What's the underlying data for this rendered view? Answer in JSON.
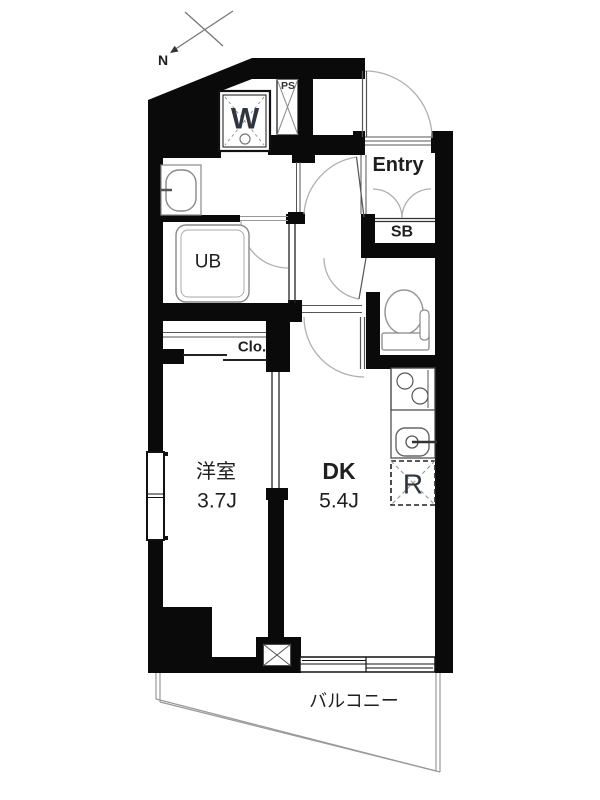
{
  "plan_title": "1DK apartment floor plan",
  "colors": {
    "walls": "#0a0a0a",
    "lines": "#999999",
    "text": "#1f1f1f",
    "fixture_letter": "#2e3440",
    "background": "#ffffff"
  },
  "compass": {
    "label": "N"
  },
  "rooms": {
    "entry": {
      "label": "Entry"
    },
    "shoe_box": {
      "label": "SB"
    },
    "unit_bath": {
      "label": "UB"
    },
    "closet": {
      "label": "Clo."
    },
    "western_room": {
      "label": "洋室",
      "size": "3.7J"
    },
    "dining_kitchen": {
      "label": "DK",
      "size": "5.4J"
    },
    "balcony": {
      "label": "バルコニー"
    }
  },
  "fixtures": {
    "washing_machine": {
      "label": "W"
    },
    "pipe_space": {
      "label": "PS"
    },
    "refrigerator": {
      "label": "R"
    }
  }
}
